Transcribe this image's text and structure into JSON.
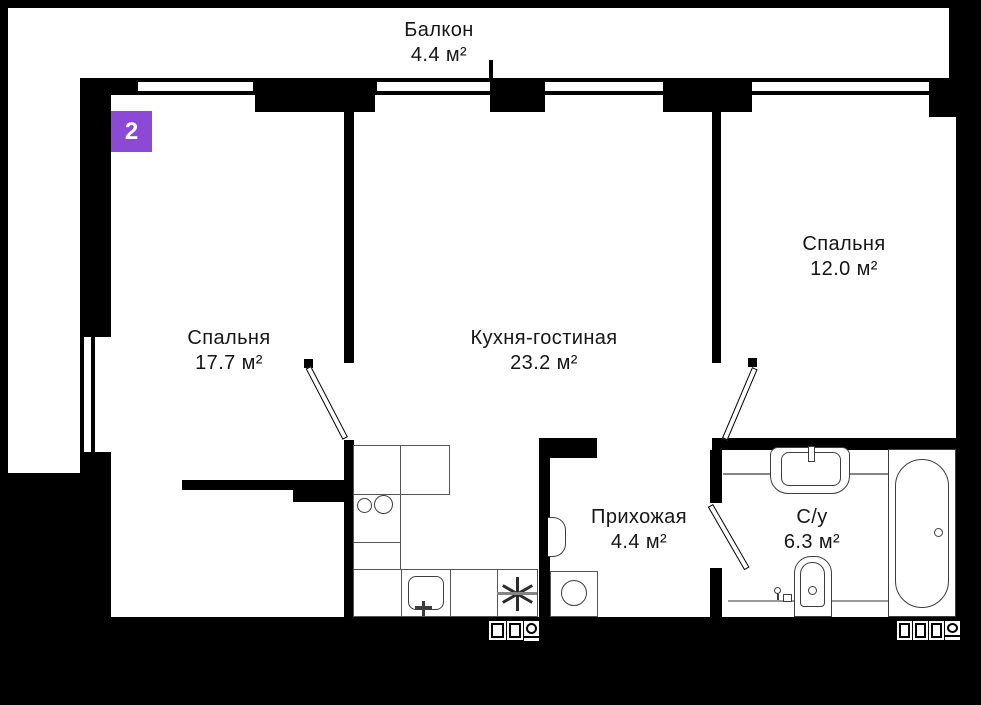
{
  "plan_type": "apartment-floor-plan",
  "badge": {
    "label": "2",
    "color": "#8B49D6"
  },
  "rooms": [
    {
      "name": "Балкон",
      "area": "4.4 м²"
    },
    {
      "name": "Спальня",
      "area": "17.7 м²"
    },
    {
      "name": "Кухня-гостиная",
      "area": "23.2 м²"
    },
    {
      "name": "Спальня",
      "area": "12.0 м²"
    },
    {
      "name": "Прихожая",
      "area": "4.4 м²"
    },
    {
      "name": "С/у",
      "area": "6.3 м²"
    }
  ],
  "colors": {
    "walls": "#000000",
    "background": "#ffffff",
    "badge": "#8B49D6",
    "fixtures": "#3d3d3d"
  }
}
